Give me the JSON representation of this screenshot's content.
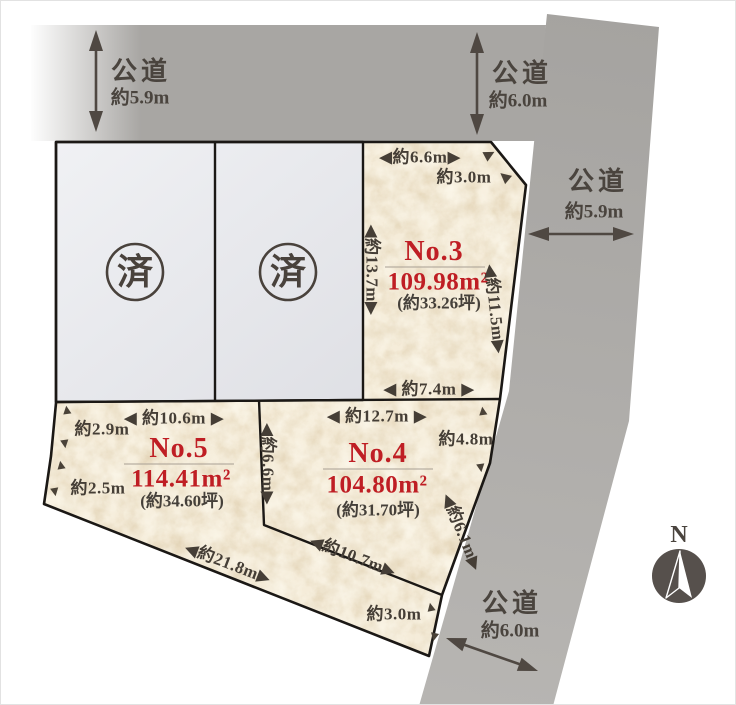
{
  "title": "土地区画図",
  "colors": {
    "road_gray": "#a8a6a3",
    "plot_paper": "#f5ecd9",
    "sold_fill": "#e4e5e9",
    "boundary_line": "#1b1815",
    "text_dark": "#453e36",
    "accent_red": "#bf1e24"
  },
  "glyphs": {
    "tri_up": "▲",
    "tri_down": "▼",
    "tri_left": "◀",
    "tri_right": "▶"
  },
  "roads": {
    "top_left": {
      "name": "公道",
      "width": "約5.9m"
    },
    "top_center": {
      "name": "公道",
      "width": "約6.0m"
    },
    "right": {
      "name": "公道",
      "width": "約5.9m"
    },
    "bottom": {
      "name": "公道",
      "width": "約6.0m"
    }
  },
  "plots": {
    "no3": {
      "number": "No.3",
      "area": "109.98m²",
      "tsubo": "(約33.26坪)"
    },
    "no4": {
      "number": "No.4",
      "area": "104.80m²",
      "tsubo": "(約31.70坪)"
    },
    "no5": {
      "number": "No.5",
      "area": "114.41m²",
      "tsubo": "(約34.60坪)"
    },
    "sold_left": {
      "badge": "済"
    },
    "sold_right": {
      "badge": "済"
    }
  },
  "dimensions": {
    "no3_top": "◀約6.6m▶",
    "no3_corner_cut": "約3.0m",
    "no3_left": "◀約13.7m▶",
    "no3_right": "◀約11.5m▶",
    "no3_bottom": "◀ 約7.4m ▶",
    "no5_top": "◀ 約10.6m ▶",
    "no5_left_upper": "約2.9m",
    "no5_left_lower": "約2.5m",
    "no5_bottom": "◀約21.8m▶",
    "no4_top": "◀ 約12.7m ▶",
    "no4_right_upper": "約4.8m",
    "no4_right_lower": "◀約6.1m▶",
    "no4_no5_boundary": "◀約6.6m▶",
    "no4_bottom": "◀約10.7m▶",
    "frontage_south": "約3.0m"
  },
  "compass": {
    "north": "N"
  }
}
